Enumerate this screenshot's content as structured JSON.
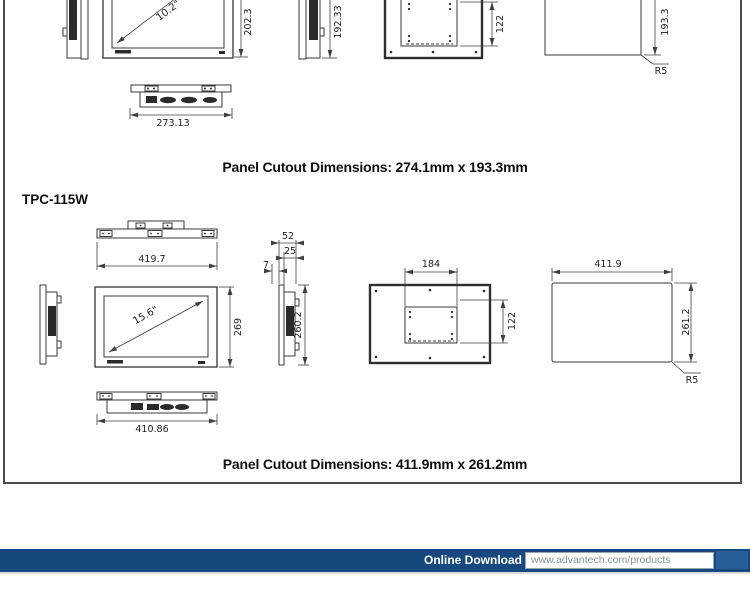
{
  "sections": [
    {
      "name": "tpc-110w-views",
      "labels": {
        "diagonal": "10.2\"",
        "front_height": "202.3",
        "side_height": "192.33",
        "vesa_height": "122",
        "cutout_height": "193.3",
        "corner_radius": "R5",
        "bottom_width": "273.13"
      },
      "caption": "Panel Cutout Dimensions: 274.1mm x 193.3mm"
    },
    {
      "name": "tpc-115w-views",
      "title": "TPC-115W",
      "labels": {
        "top_width": "419.7",
        "diagonal": "15.6\"",
        "front_height": "269",
        "depth_total": "52",
        "depth_rear": "25",
        "depth_bezel": "7",
        "side_height": "260.2",
        "vesa_width": "184",
        "vesa_height": "122",
        "cutout_width": "411.9",
        "cutout_height": "261.2",
        "corner_radius": "R5",
        "bottom_width": "410.86"
      },
      "caption": "Panel Cutout Dimensions: 411.9mm x 261.2mm"
    }
  ],
  "footer": {
    "label": "Online Download",
    "url": "www.advantech.com/products",
    "bar_color": "#17497e"
  }
}
